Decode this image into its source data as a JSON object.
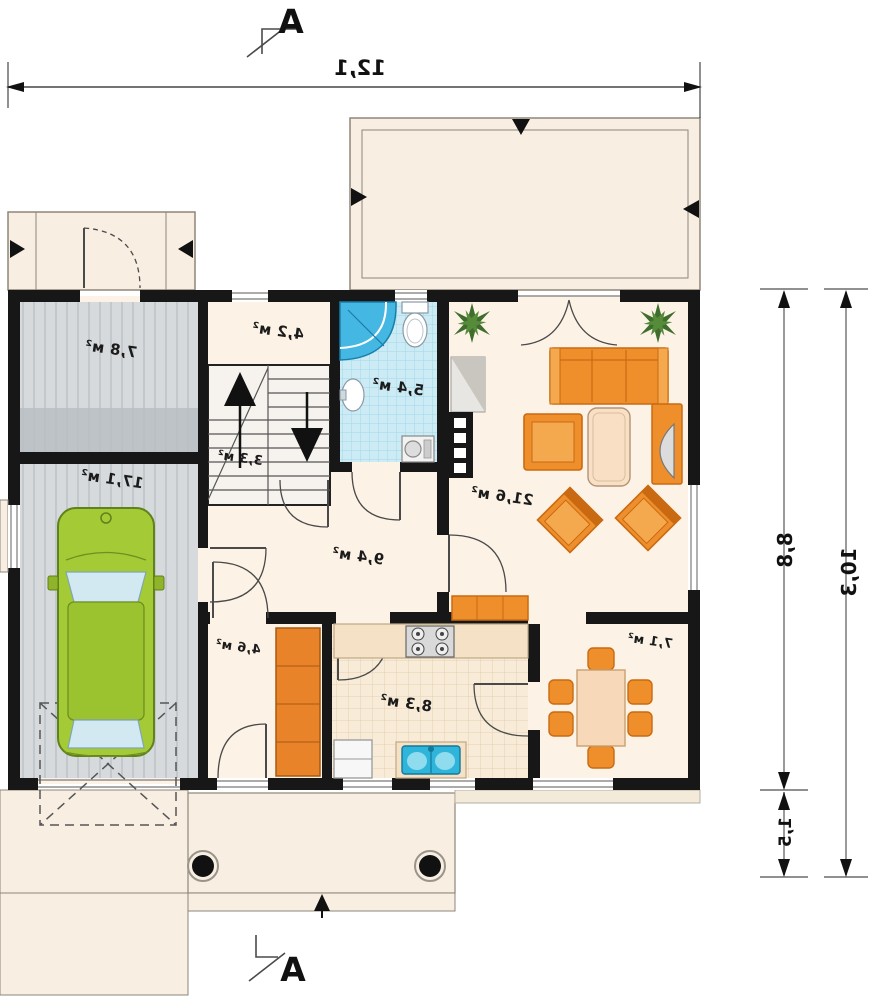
{
  "plan": {
    "type": "floor-plan-ground-floor-mirrored",
    "section_marker_top": "A",
    "section_marker_bottom": "A",
    "dimensions": {
      "total_width": "12,1",
      "house_depth": "8,8",
      "total_depth": "10,3",
      "porch_depth": "1,5"
    },
    "rooms": [
      {
        "name": "utility-room",
        "area": "7,8 м²"
      },
      {
        "name": "entry-hall",
        "area": "4,2 м²"
      },
      {
        "name": "staircase",
        "area": "3,3 м²"
      },
      {
        "name": "bathroom",
        "area": "5,4 м²"
      },
      {
        "name": "garage",
        "area": "17,1 м²"
      },
      {
        "name": "hall",
        "area": "9,4 м²"
      },
      {
        "name": "living-room",
        "area": "21,6 м²"
      },
      {
        "name": "corridor",
        "area": "4,6 м²"
      },
      {
        "name": "kitchen",
        "area": "8,3 м²"
      },
      {
        "name": "dining-room",
        "area": "7,1 м²"
      }
    ],
    "colors": {
      "wall": "#171717",
      "furniture_orange": "#ef8f2c",
      "bathroom_tile": "#cdebf5",
      "kitchen_tile": "#f8ecd9",
      "car_green": "#a4ca35",
      "floor_cream": "#fcf3e6",
      "floor_gray": "#d6dadd",
      "outdoor_cream": "#f8efe2"
    }
  }
}
